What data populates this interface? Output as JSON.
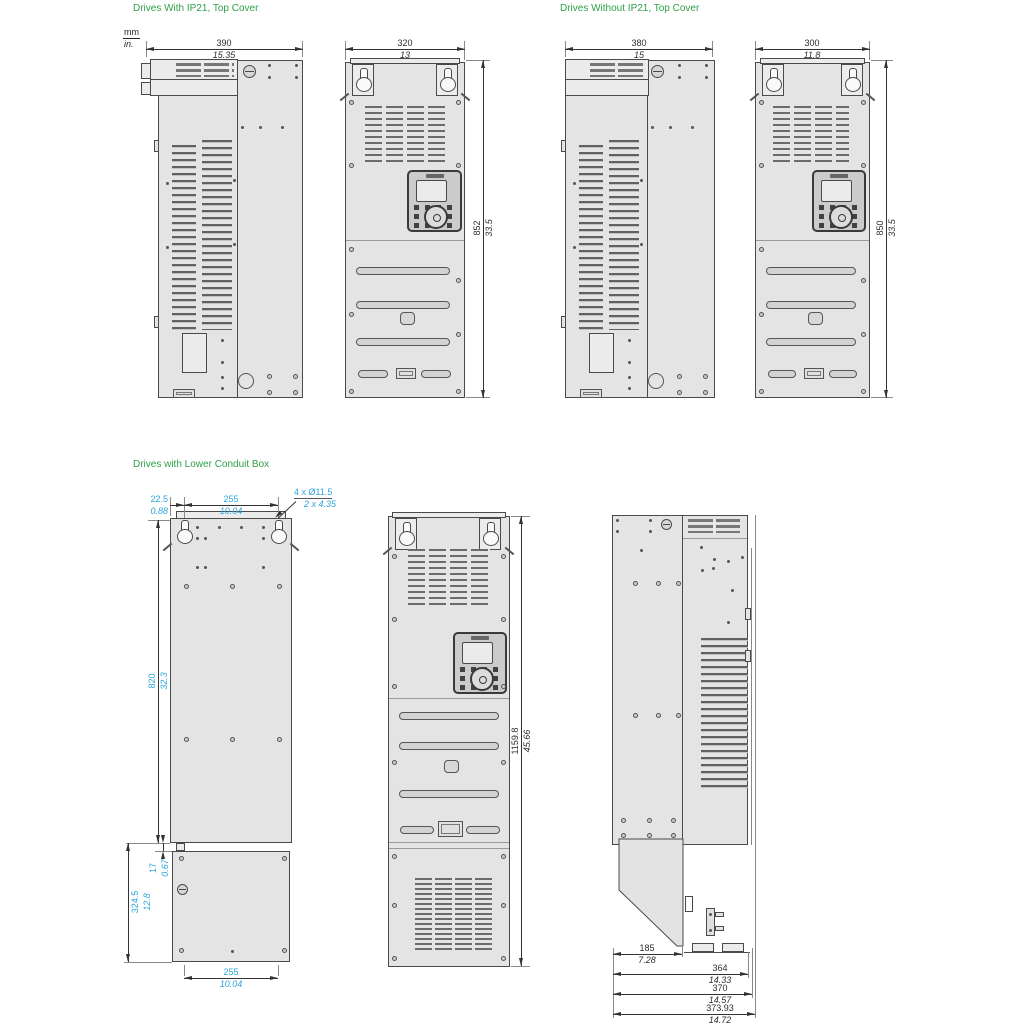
{
  "page": {
    "units_mm": "mm",
    "units_in": "in.",
    "colors": {
      "title_green": "#2FA04A",
      "dim_cyan": "#2BA6DF",
      "dim_dark": "#333333",
      "drawing_line": "#4a4a4a"
    }
  },
  "sections": {
    "with_ip21": {
      "title": "Drives With IP21, Top Cover",
      "dims": {
        "side_width": {
          "mm": "390",
          "in": "15.35"
        },
        "front_width": {
          "mm": "320",
          "in": "13"
        },
        "height": {
          "mm": "852",
          "in": "33.5"
        }
      }
    },
    "without_ip21": {
      "title": "Drives Without IP21, Top Cover",
      "dims": {
        "side_width": {
          "mm": "380",
          "in": "15"
        },
        "front_width": {
          "mm": "300",
          "in": "11.8"
        },
        "height": {
          "mm": "850",
          "in": "33.5"
        }
      }
    },
    "lower_conduit": {
      "title": "Drives with Lower Conduit Box",
      "dims": {
        "edge_offset": {
          "mm": "22.5",
          "in": "0.88"
        },
        "hole_spacing_top": {
          "mm": "255",
          "in": "10.04"
        },
        "mounting_holes": {
          "mm": "4 x Ø11.5",
          "in": "2 x 4.35"
        },
        "body_height": {
          "mm": "820",
          "in": "32.3"
        },
        "gap": {
          "mm": "17",
          "in": "0.67"
        },
        "conduit_height": {
          "mm": "324.5",
          "in": "12.8"
        },
        "hole_spacing_bottom": {
          "mm": "255",
          "in": "10.04"
        },
        "total_height": {
          "mm": "1159.8",
          "in": "45.66"
        },
        "conduit_depth": {
          "mm": "185",
          "in": "7.28"
        },
        "depth_body": {
          "mm": "364",
          "in": "14.33"
        },
        "depth_door": {
          "mm": "370",
          "in": "14.57"
        },
        "depth_total": {
          "mm": "373.93",
          "in": "14.72"
        }
      }
    }
  }
}
